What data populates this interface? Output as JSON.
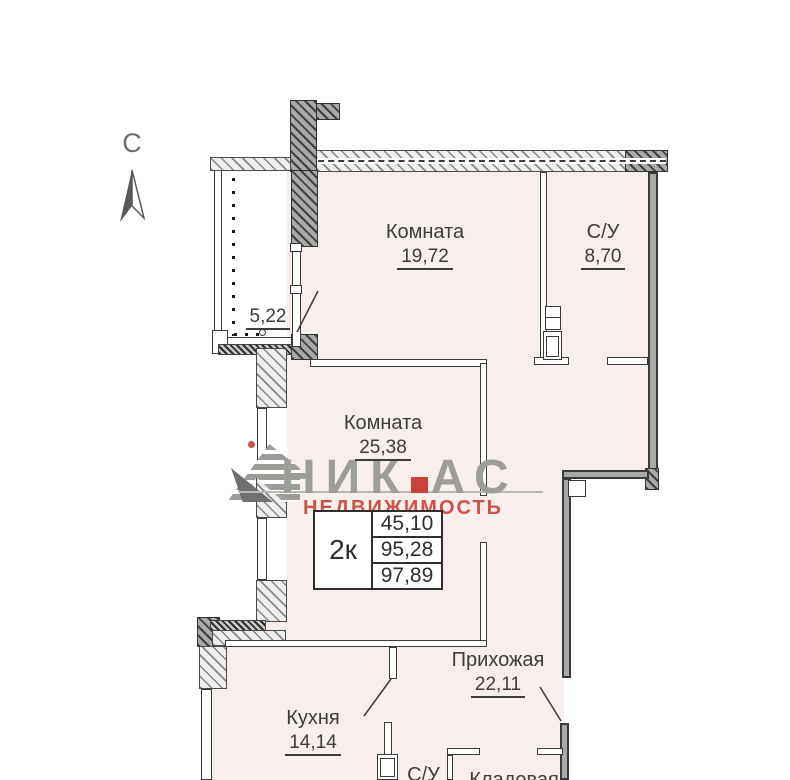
{
  "plan": {
    "compass_label": "С",
    "balcony_area": "5,22",
    "rooms": {
      "room1": {
        "name": "Комната",
        "area": "19,72"
      },
      "bathroom_top": {
        "name": "С/У",
        "area": "8,70"
      },
      "room2": {
        "name": "Комната",
        "area": "25,38"
      },
      "hallway": {
        "name": "Прихожая",
        "area": "22,11"
      },
      "kitchen": {
        "name": "Кухня",
        "area": "14,14"
      },
      "bathroom_bottom": {
        "name": "С/У"
      },
      "storage": {
        "name": "Кладовая"
      }
    },
    "info_table": {
      "type": "2к",
      "values": [
        "45,10",
        "95,28",
        "97,89"
      ]
    },
    "logo": {
      "name_part1": "НИК",
      "name_part2": "АС",
      "subtitle": "НЕДВИЖИМОСТЬ"
    },
    "colors": {
      "logo_gray": "#9c9c99",
      "logo_red": "#d0504b",
      "floor_fill": "#f8efec"
    }
  }
}
